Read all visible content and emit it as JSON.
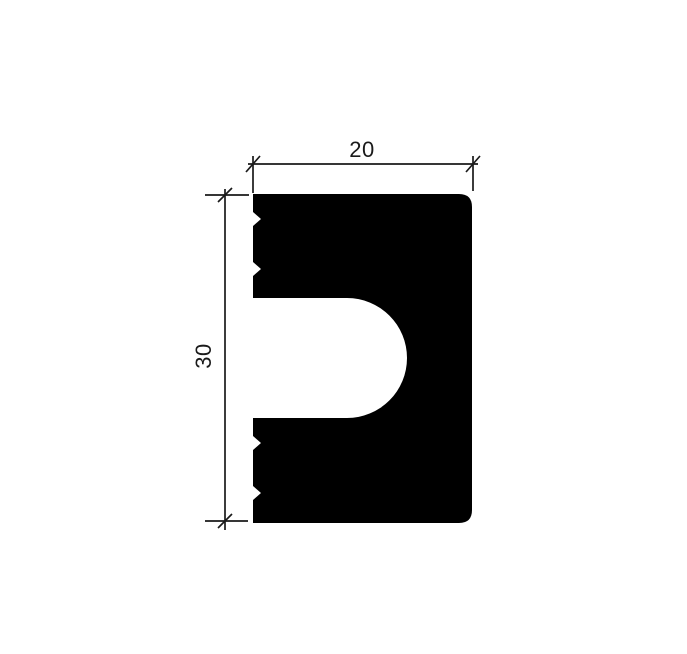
{
  "page": {
    "background_color": "#ffffff"
  },
  "drawing": {
    "kind": "profile-cross-section",
    "ink_color": "#000000",
    "line_color": "#1a1a1a",
    "profile_path": "M253,194 L459,194 Q472,194 472,207 L472,510 Q472,523 459,523 L253,523 L253,500 L261,493 L253,486 L253,450 L261,443 L253,436 L253,418 L347,418 A60,60 0 0 0 347,298 L253,298 L253,276 L261,269 L253,262 L253,226 L261,219 L253,212 Z",
    "width_dimension": {
      "label": "20",
      "value": 20
    },
    "height_dimension": {
      "label": "30",
      "value": 30
    }
  }
}
